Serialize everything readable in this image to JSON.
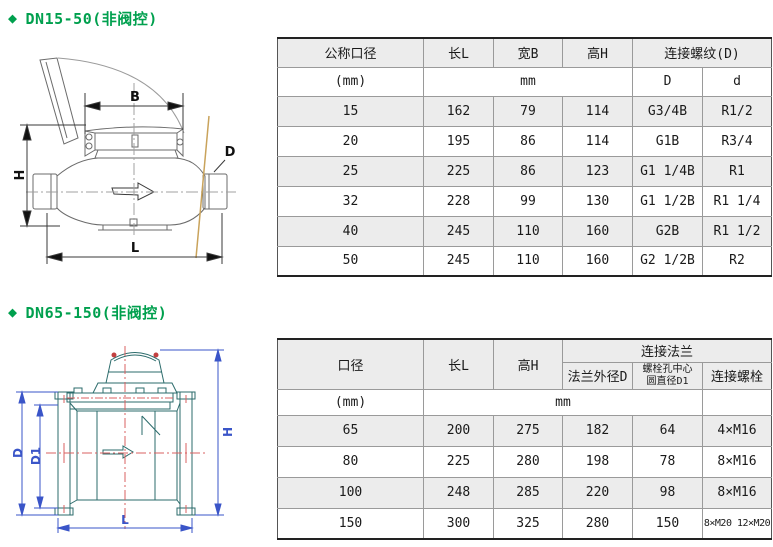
{
  "colors": {
    "accent_green": "#00A04E",
    "row_shade": "#ECECEC",
    "drawing1_line": "#6b6b6b",
    "drawing1_tan": "#C9A35B",
    "drawing2_teal": "#2B6B6B",
    "drawing2_blue": "#3A55C8",
    "drawing2_red": "#D96060"
  },
  "section1": {
    "bullet": "◆",
    "title": "DN15-50(非阀控)",
    "diagram_labels": {
      "B": "B",
      "H": "H",
      "D": "D",
      "L": "L"
    },
    "table": {
      "headers": {
        "nominal": "公称口径",
        "length": "长L",
        "width": "宽B",
        "height": "高H",
        "thread_group": "连接螺纹(D)",
        "thread_D": "D",
        "thread_d": "d"
      },
      "unit_row": {
        "nominal": "(mm)",
        "dims": "mm"
      },
      "rows": [
        [
          "15",
          "162",
          "79",
          "114",
          "G3/4B",
          "R1/2"
        ],
        [
          "20",
          "195",
          "86",
          "114",
          "G1B",
          "R3/4"
        ],
        [
          "25",
          "225",
          "86",
          "123",
          "G1 1/4B",
          "R1"
        ],
        [
          "32",
          "228",
          "99",
          "130",
          "G1 1/2B",
          "R1 1/4"
        ],
        [
          "40",
          "245",
          "110",
          "160",
          "G2B",
          "R1 1/2"
        ],
        [
          "50",
          "245",
          "110",
          "160",
          "G2 1/2B",
          "R2"
        ]
      ]
    }
  },
  "section2": {
    "bullet": "◆",
    "title": "DN65-150(非阀控)",
    "diagram_labels": {
      "D": "D",
      "D1": "D1",
      "H": "H",
      "L": "L"
    },
    "table": {
      "headers": {
        "nominal": "口径",
        "length": "长L",
        "height": "高H",
        "flange_group": "连接法兰",
        "flange_od": "法兰外径D",
        "bolt_circle_line1": "螺栓孔中心",
        "bolt_circle_line2": "圆直径D1",
        "bolts": "连接螺栓"
      },
      "unit_row": {
        "nominal": "(mm)",
        "dims": "mm"
      },
      "rows": [
        [
          "65",
          "200",
          "275",
          "182",
          "64",
          "4×M16"
        ],
        [
          "80",
          "225",
          "280",
          "198",
          "78",
          "8×M16"
        ],
        [
          "100",
          "248",
          "285",
          "220",
          "98",
          "8×M16"
        ],
        [
          "150",
          "300",
          "325",
          "280",
          "150",
          "8×M20 12×M20"
        ]
      ]
    }
  }
}
